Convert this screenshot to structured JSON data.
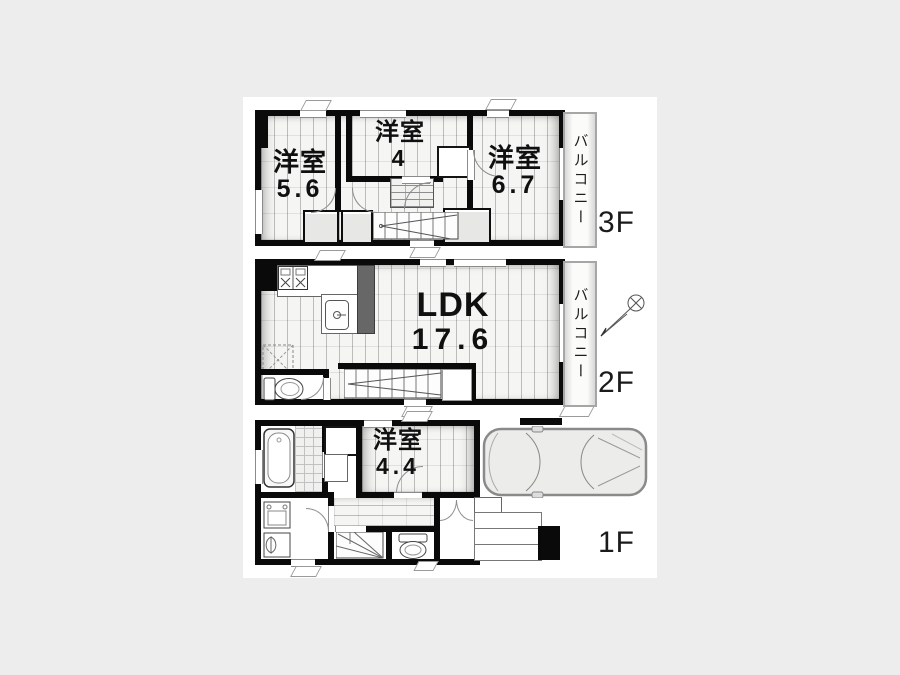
{
  "colors": {
    "background": "#ededed",
    "panel": "#ffffff",
    "wall": "#0a0a0a",
    "floor_fill": "#f5f5f3",
    "closet_fill": "#e7e7e5",
    "balcony_border": "#a6a6a6"
  },
  "floors": {
    "f3": {
      "label": "3F",
      "balcony": "バルコニー",
      "rooms": {
        "left": {
          "name": "洋室",
          "size": "5.6"
        },
        "mid": {
          "name": "洋室",
          "size": "4"
        },
        "right": {
          "name": "洋室",
          "size": "6.7"
        }
      }
    },
    "f2": {
      "label": "2F",
      "balcony": "バルコニー",
      "ldk": {
        "name": "LDK",
        "size": "17.6"
      }
    },
    "f1": {
      "label": "1F",
      "room": {
        "name": "洋室",
        "size": "4.4"
      }
    }
  }
}
